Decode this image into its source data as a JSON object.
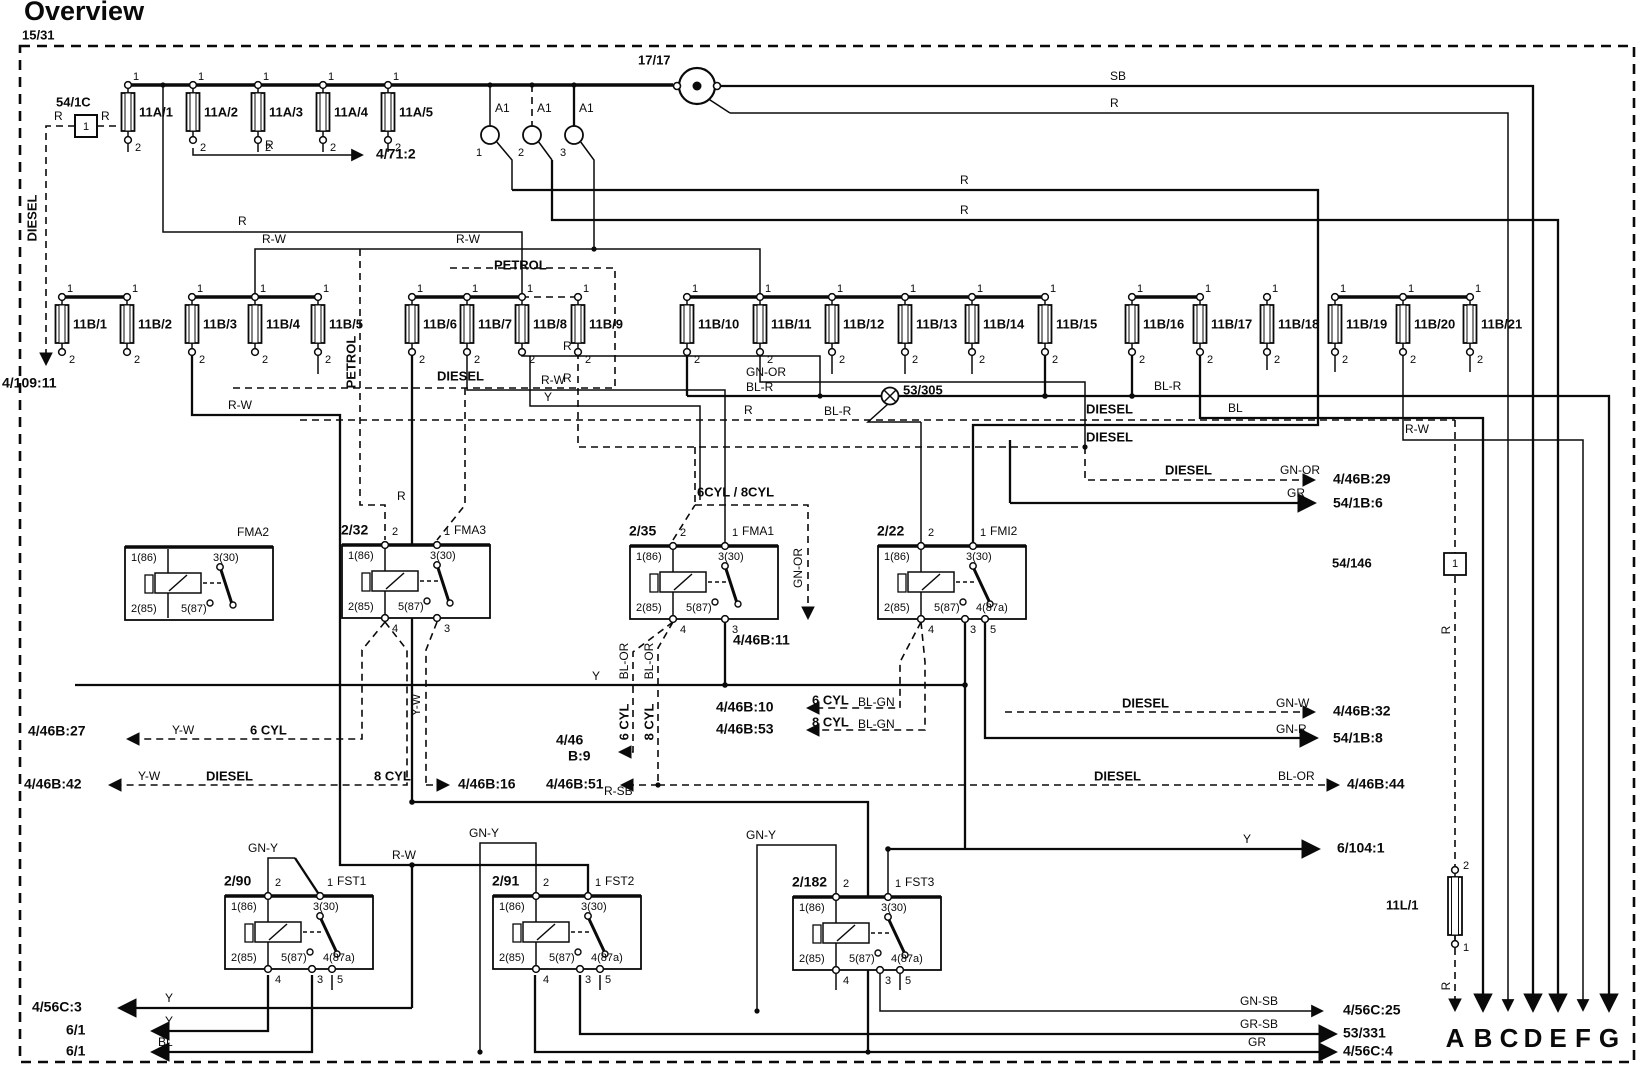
{
  "title": "Overview",
  "frame_id": "15/31",
  "fuse_template": {
    "pin_top": "1",
    "pin_bottom": "2"
  },
  "relay_template": {
    "coil_top": "1(86)",
    "switch_top": "3(30)",
    "coil_bottom": "2(85)",
    "out_center": "5(87)",
    "out_right": "4(87a)",
    "pin_top_left": "2",
    "pin_top_right": "1",
    "pin_bot_left": "4",
    "pin_bot_center": "3",
    "pin_bot_right": "5"
  },
  "fuse_rows": [
    {
      "y": 85,
      "fuses": [
        {
          "x": 128,
          "name": "11A/1"
        },
        {
          "x": 193,
          "name": "11A/2"
        },
        {
          "x": 258,
          "name": "11A/3"
        },
        {
          "x": 323,
          "name": "11A/4"
        },
        {
          "x": 388,
          "name": "11A/5"
        }
      ]
    },
    {
      "y": 297,
      "fuses": [
        {
          "x": 62,
          "name": "11B/1"
        },
        {
          "x": 127,
          "name": "11B/2"
        },
        {
          "x": 192,
          "name": "11B/3"
        },
        {
          "x": 255,
          "name": "11B/4"
        },
        {
          "x": 318,
          "name": "11B/5"
        },
        {
          "x": 412,
          "name": "11B/6"
        },
        {
          "x": 467,
          "name": "11B/7"
        },
        {
          "x": 522,
          "name": "11B/8"
        },
        {
          "x": 578,
          "name": "11B/9"
        },
        {
          "x": 687,
          "name": "11B/10"
        },
        {
          "x": 760,
          "name": "11B/11"
        },
        {
          "x": 832,
          "name": "11B/12"
        },
        {
          "x": 905,
          "name": "11B/13"
        },
        {
          "x": 972,
          "name": "11B/14"
        },
        {
          "x": 1045,
          "name": "11B/15"
        },
        {
          "x": 1132,
          "name": "11B/16"
        },
        {
          "x": 1200,
          "name": "11B/17"
        },
        {
          "x": 1267,
          "name": "11B/18"
        },
        {
          "x": 1335,
          "name": "11B/19"
        },
        {
          "x": 1403,
          "name": "11B/20"
        },
        {
          "x": 1470,
          "name": "11B/21"
        }
      ]
    }
  ],
  "relays": [
    {
      "x": 125,
      "y": 547,
      "id": "",
      "name": "FMA2",
      "a": false,
      "pins": false
    },
    {
      "x": 342,
      "y": 545,
      "id": "2/32",
      "name": "FMA3",
      "a": false,
      "pins": true
    },
    {
      "x": 630,
      "y": 546,
      "id": "2/35",
      "name": "FMA1",
      "a": false,
      "pins": true
    },
    {
      "x": 878,
      "y": 546,
      "id": "2/22",
      "name": "FMI2",
      "a": true,
      "pins": true
    },
    {
      "x": 225,
      "y": 896,
      "id": "2/90",
      "name": "FST1",
      "a": true,
      "pins": true
    },
    {
      "x": 493,
      "y": 896,
      "id": "2/91",
      "name": "FST2",
      "a": true,
      "pins": true
    },
    {
      "x": 793,
      "y": 897,
      "id": "2/182",
      "name": "FST3",
      "a": true,
      "pins": true
    }
  ],
  "misc": {
    "ignition_switch": "17/17",
    "ground_point": "53/305",
    "inline_connector": "54/146",
    "lamp_fuse": "11L/1",
    "resistor": "54/1C",
    "a1_connector": "A1"
  },
  "labels": [
    [
      22,
      36,
      "15/31",
      "b"
    ],
    [
      56,
      103,
      "54/1C",
      "b"
    ],
    [
      54,
      117,
      "R",
      "n"
    ],
    [
      101,
      117,
      "R",
      "n"
    ],
    [
      495,
      109,
      "A1",
      "n"
    ],
    [
      537,
      109,
      "A1",
      "n"
    ],
    [
      579,
      109,
      "A1",
      "n"
    ],
    [
      476,
      153,
      "1",
      "s"
    ],
    [
      518,
      153,
      "2",
      "s"
    ],
    [
      560,
      153,
      "3",
      "s"
    ],
    [
      638,
      61,
      "17/17",
      "b"
    ],
    [
      265,
      146,
      "R",
      "n"
    ],
    [
      376,
      155,
      "4/71:2",
      "B"
    ],
    [
      1110,
      77,
      "SB",
      "n"
    ],
    [
      1110,
      104,
      "R",
      "n"
    ],
    [
      960,
      181,
      "R",
      "n"
    ],
    [
      960,
      211,
      "R",
      "n"
    ],
    [
      238,
      222,
      "R",
      "n"
    ],
    [
      262,
      240,
      "R-W",
      "n"
    ],
    [
      456,
      240,
      "R-W",
      "n"
    ],
    [
      33,
      218,
      "DIESEL",
      "rb"
    ],
    [
      2,
      384,
      "4/109:11",
      "B"
    ],
    [
      494,
      266,
      "PETROL",
      "b"
    ],
    [
      352,
      362,
      "PETROL",
      "rb"
    ],
    [
      437,
      377,
      "DIESEL",
      "b"
    ],
    [
      563,
      347,
      "R",
      "n"
    ],
    [
      563,
      379,
      "R",
      "n"
    ],
    [
      228,
      406,
      "R-W",
      "n"
    ],
    [
      541,
      381,
      "R-W",
      "n"
    ],
    [
      544,
      398,
      "Y",
      "n"
    ],
    [
      746,
      373,
      "GN-OR",
      "n"
    ],
    [
      746,
      388,
      "BL-R",
      "n"
    ],
    [
      824,
      412,
      "BL-R",
      "n"
    ],
    [
      903,
      391,
      "53/305",
      "b"
    ],
    [
      744,
      411,
      "R",
      "n"
    ],
    [
      1086,
      410,
      "DIESEL",
      "b"
    ],
    [
      1086,
      438,
      "DIESEL",
      "b"
    ],
    [
      1228,
      409,
      "BL",
      "n"
    ],
    [
      1154,
      387,
      "BL-R",
      "n"
    ],
    [
      1405,
      430,
      "R-W",
      "n"
    ],
    [
      1165,
      471,
      "DIESEL",
      "b"
    ],
    [
      1280,
      471,
      "GN-OR",
      "n"
    ],
    [
      1333,
      480,
      "4/46B:29",
      "B"
    ],
    [
      1287,
      494,
      "GR",
      "n"
    ],
    [
      1333,
      504,
      "54/1B:6",
      "B"
    ],
    [
      697,
      493,
      "6CYL / 8CYL",
      "b"
    ],
    [
      397,
      497,
      "R",
      "n"
    ],
    [
      799,
      568,
      "GN-OR",
      "r"
    ],
    [
      733,
      641,
      "4/46B:11",
      "B"
    ],
    [
      1332,
      564,
      "54/146",
      "b"
    ],
    [
      1455,
      564,
      "1",
      "sc"
    ],
    [
      1447,
      630,
      "R",
      "r"
    ],
    [
      625,
      661,
      "BL-OR",
      "r"
    ],
    [
      650,
      661,
      "BL-OR",
      "r"
    ],
    [
      625,
      722,
      "6 CYL",
      "rb"
    ],
    [
      650,
      722,
      "8 CYL",
      "rb"
    ],
    [
      592,
      677,
      "Y",
      "n"
    ],
    [
      417,
      705,
      "Y-W",
      "r"
    ],
    [
      28,
      732,
      "4/46B:27",
      "B"
    ],
    [
      172,
      731,
      "Y-W",
      "n"
    ],
    [
      250,
      731,
      "6 CYL",
      "b"
    ],
    [
      716,
      708,
      "4/46B:10",
      "B"
    ],
    [
      812,
      701,
      "6 CYL",
      "b"
    ],
    [
      858,
      703,
      "BL-GN",
      "n"
    ],
    [
      716,
      730,
      "4/46B:53",
      "B"
    ],
    [
      812,
      723,
      "8 CYL",
      "b"
    ],
    [
      858,
      725,
      "BL-GN",
      "n"
    ],
    [
      556,
      741,
      "4/46",
      "B"
    ],
    [
      568,
      757,
      "B:9",
      "B"
    ],
    [
      1122,
      704,
      "DIESEL",
      "b"
    ],
    [
      1276,
      704,
      "GN-W",
      "n"
    ],
    [
      1333,
      712,
      "4/46B:32",
      "B"
    ],
    [
      1276,
      730,
      "GN-R",
      "n"
    ],
    [
      1333,
      739,
      "54/1B:8",
      "B"
    ],
    [
      24,
      785,
      "4/46B:42",
      "B"
    ],
    [
      138,
      777,
      "Y-W",
      "n"
    ],
    [
      206,
      777,
      "DIESEL",
      "b"
    ],
    [
      374,
      777,
      "8 CYL",
      "b"
    ],
    [
      458,
      785,
      "4/46B:16",
      "B"
    ],
    [
      546,
      785,
      "4/46B:51",
      "B"
    ],
    [
      1094,
      777,
      "DIESEL",
      "b"
    ],
    [
      1278,
      777,
      "BL-OR",
      "n"
    ],
    [
      1347,
      785,
      "4/46B:44",
      "B"
    ],
    [
      604,
      792,
      "R-SB",
      "n"
    ],
    [
      248,
      849,
      "GN-Y",
      "n"
    ],
    [
      392,
      856,
      "R-W",
      "n"
    ],
    [
      469,
      834,
      "GN-Y",
      "n"
    ],
    [
      746,
      836,
      "GN-Y",
      "n"
    ],
    [
      1243,
      840,
      "Y",
      "n"
    ],
    [
      1337,
      849,
      "6/104:1",
      "B"
    ],
    [
      1386,
      906,
      "11L/1",
      "b"
    ],
    [
      1463,
      866,
      "2",
      "s"
    ],
    [
      1463,
      948,
      "1",
      "s"
    ],
    [
      1447,
      986,
      "R",
      "r"
    ],
    [
      165,
      999,
      "Y",
      "n"
    ],
    [
      165,
      1022,
      "Y",
      "n"
    ],
    [
      158,
      1043,
      "BL",
      "n"
    ],
    [
      32,
      1008,
      "4/56C:3",
      "B"
    ],
    [
      66,
      1031,
      "6/1",
      "B"
    ],
    [
      66,
      1052,
      "6/1",
      "B"
    ],
    [
      1240,
      1002,
      "GN-SB",
      "n"
    ],
    [
      1343,
      1011,
      "4/56C:25",
      "B"
    ],
    [
      1240,
      1025,
      "GR-SB",
      "n"
    ],
    [
      1343,
      1034,
      "53/331",
      "B"
    ],
    [
      1248,
      1043,
      "GR",
      "n"
    ],
    [
      1343,
      1052,
      "4/56C:4",
      "B"
    ],
    [
      1455,
      1040,
      "A",
      "big"
    ],
    [
      1483,
      1040,
      "B",
      "big"
    ],
    [
      1509,
      1040,
      "C",
      "big"
    ],
    [
      1533,
      1040,
      "D",
      "big"
    ],
    [
      1558,
      1040,
      "E",
      "big"
    ],
    [
      1583,
      1040,
      "F",
      "big"
    ],
    [
      1609,
      1040,
      "G",
      "big"
    ]
  ]
}
